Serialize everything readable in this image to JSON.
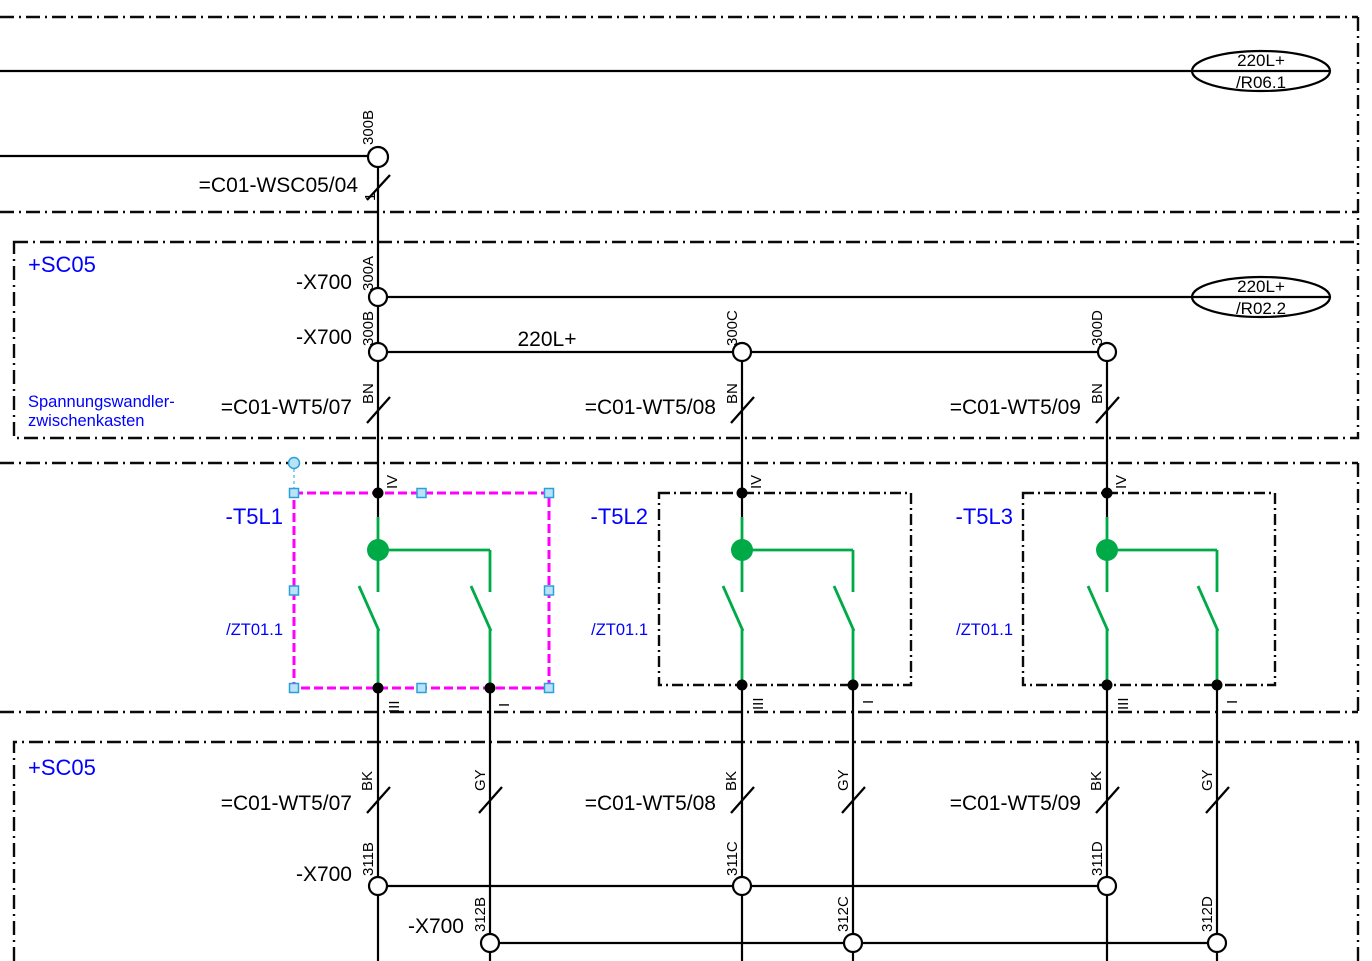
{
  "colors": {
    "line_black": "#000000",
    "label_blue": "#0000ff",
    "symbol_green": "#00ab47",
    "selection_magenta": "#ff00ff",
    "handle_cyan": "#b9e4f7"
  },
  "signal_refs": [
    {
      "signal": "220L+",
      "ref": "/R06.1"
    },
    {
      "signal": "220L+",
      "ref": "/R02.2"
    }
  ],
  "incoming": {
    "terminal": "300B",
    "cable": "=C01-WSC05/04",
    "core": "1"
  },
  "zone_top": {
    "name": "+SC05",
    "note_line1": "Spannungswandler-",
    "note_line2": "zwischenkasten",
    "wire_label": "220L+",
    "rows": [
      {
        "strip": "-X700",
        "terminal": "300A"
      },
      {
        "strip": "-X700",
        "terminal": "300B"
      }
    ],
    "bus_terminals": [
      "300C",
      "300D"
    ],
    "cables": [
      {
        "name": "=C01-WT5/07",
        "core": "BN"
      },
      {
        "name": "=C01-WT5/08",
        "core": "BN"
      },
      {
        "name": "=C01-WT5/09",
        "core": "BN"
      }
    ]
  },
  "devices": [
    {
      "tag": "-T5L1",
      "cross_ref": "/ZT01.1",
      "pins": {
        "top": "IV",
        "bottom_left": "III",
        "bottom_right": "I"
      }
    },
    {
      "tag": "-T5L2",
      "cross_ref": "/ZT01.1",
      "pins": {
        "top": "IV",
        "bottom_left": "III",
        "bottom_right": "I"
      }
    },
    {
      "tag": "-T5L3",
      "cross_ref": "/ZT01.1",
      "pins": {
        "top": "IV",
        "bottom_left": "III",
        "bottom_right": "I"
      }
    }
  ],
  "zone_bottom": {
    "name": "+SC05",
    "cables": [
      {
        "name": "=C01-WT5/07",
        "core_left": "BK",
        "core_right": "GY"
      },
      {
        "name": "=C01-WT5/08",
        "core_left": "BK",
        "core_right": "GY"
      },
      {
        "name": "=C01-WT5/09",
        "core_left": "BK",
        "core_right": "GY"
      }
    ],
    "row_311": {
      "strip": "-X700",
      "terminals": [
        "311B",
        "311C",
        "311D"
      ]
    },
    "row_312": {
      "strip": "-X700",
      "terminals": [
        "312B",
        "312C",
        "312D"
      ]
    }
  }
}
